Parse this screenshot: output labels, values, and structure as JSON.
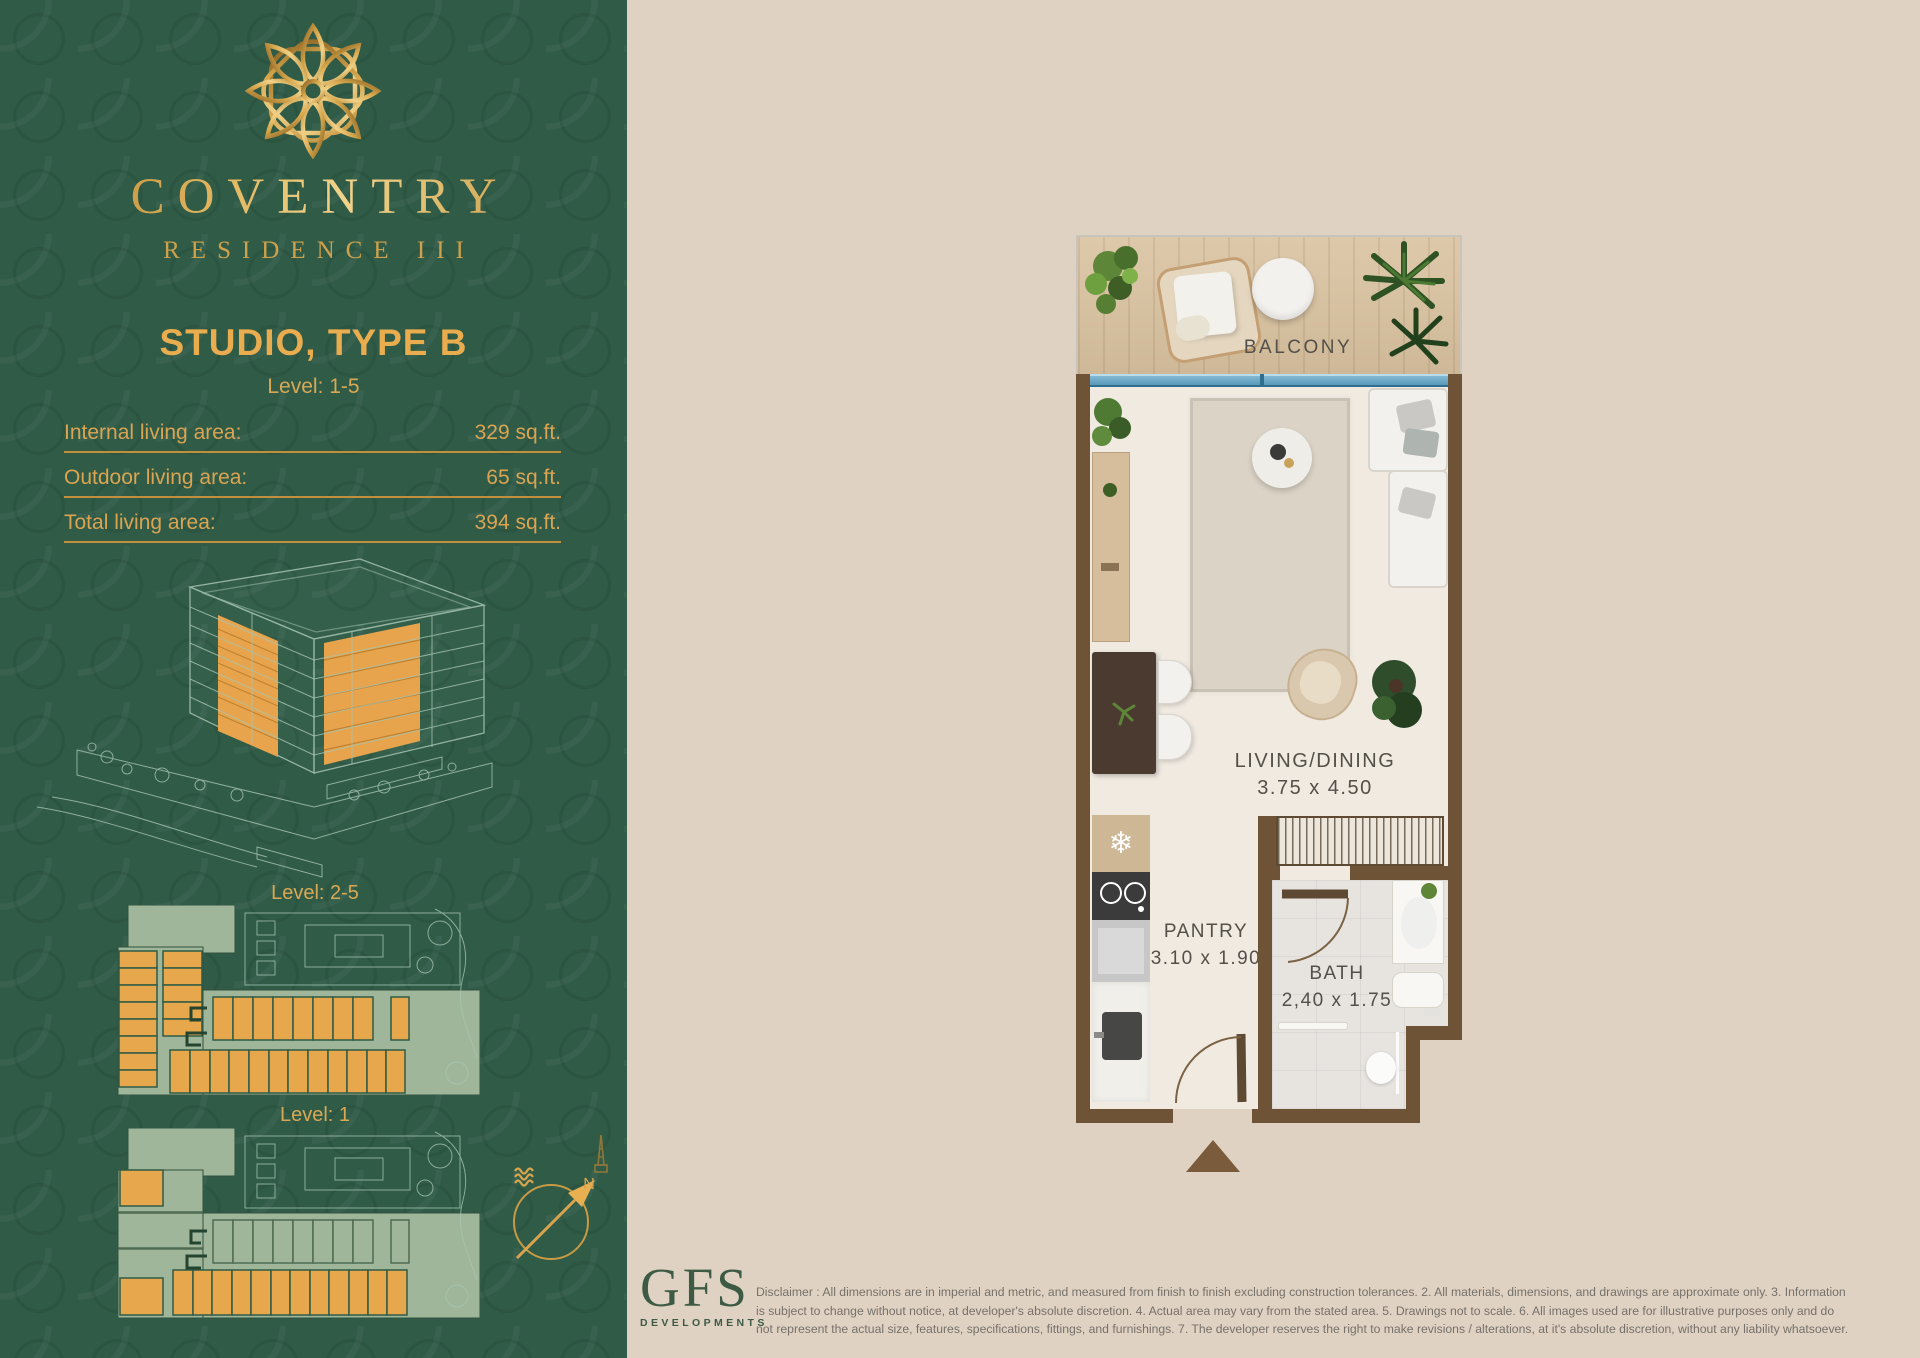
{
  "brand": {
    "name": "COVENTRY",
    "subtitle": "RESIDENCE III"
  },
  "unit": {
    "title": "STUDIO, TYPE B",
    "level": "Level: 1-5"
  },
  "areas": [
    {
      "label": "Internal living area:",
      "value": "329 sq.ft."
    },
    {
      "label": "Outdoor living area:",
      "value": "65 sq.ft."
    },
    {
      "label": "Total living area:",
      "value": "394 sq.ft."
    }
  ],
  "key_plans": [
    {
      "label": "Level: 2-5"
    },
    {
      "label": "Level: 1"
    }
  ],
  "compass": {
    "north_label": "N"
  },
  "floorplan": {
    "balcony": {
      "label": "BALCONY"
    },
    "living": {
      "label": "LIVING/DINING",
      "dims": "3.75 x 4.50"
    },
    "pantry": {
      "label": "PANTRY",
      "dims": "3.10 x 1.90"
    },
    "bath": {
      "label": "BATH",
      "dims": "2,40 x 1.75"
    }
  },
  "developer": {
    "name": "GFS",
    "subtitle": "DEVELOPMENTS"
  },
  "disclaimer_lines": [
    "Disclaimer : All dimensions are in imperial and metric, and measured from finish to finish excluding construction tolerances. 2. All materials, dimensions, and drawings are approximate only. 3. Information",
    "is subject to change without notice,  at developer's absolute discretion. 4. Actual area may vary from the stated area. 5. Drawings not to scale. 6. All images used are for illustrative purposes only and do",
    "not represent the actual size, features, specifications, fittings, and furnishings.  7. The developer reserves the right to make revisions / alterations, at it's absolute discretion, without any liability whatsoever."
  ],
  "colors": {
    "brand_green": "#2F5B47",
    "brand_gold": "#D8A74F",
    "highlight_unit_yellow": "#E7A84D",
    "keyplan_sage": "#9FB69B",
    "page_beige": "#DFD2C2",
    "wall_brown": "#6F5336",
    "window_blue": "#4E92B4"
  }
}
